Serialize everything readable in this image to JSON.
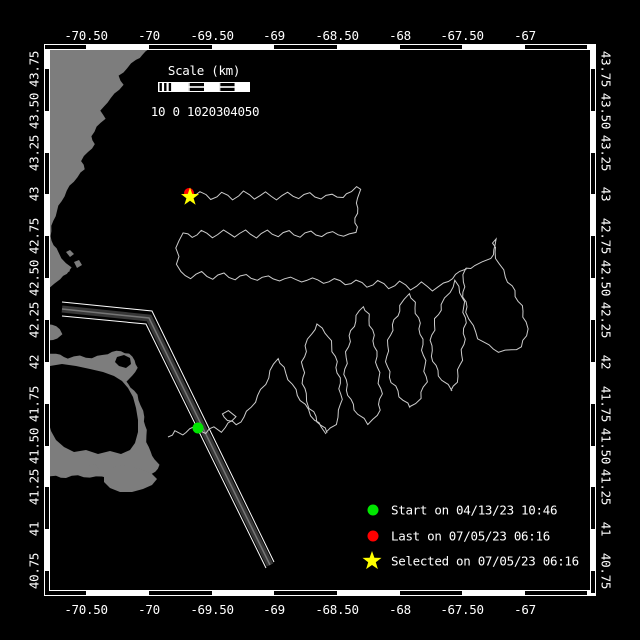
{
  "colors": {
    "background": "#000000",
    "land": "#7d7d7d",
    "water": "#000000",
    "track": "#cccccc",
    "frame_white": "#ffffff",
    "frame_black": "#000000",
    "text": "#ffffff",
    "start_green": "#00e600",
    "last_red": "#ff0000",
    "selected_yellow": "#ffff00",
    "lane_band": "#383838",
    "lane_core": "#757575"
  },
  "axes": {
    "top": {
      "labels": [
        "-70.50",
        "-70",
        "-69.50",
        "-69",
        "-68.50",
        "-68",
        "-67.50",
        "-67"
      ],
      "xs": [
        86,
        149,
        212,
        274,
        337,
        400,
        462,
        525
      ],
      "y": 40
    },
    "bottom": {
      "labels": [
        "-70.50",
        "-70",
        "-69.50",
        "-69",
        "-68.50",
        "-68",
        "-67.50",
        "-67"
      ],
      "xs": [
        86,
        149,
        212,
        274,
        337,
        400,
        462,
        525
      ],
      "y": 614
    },
    "left": {
      "labels": [
        "43.75",
        "43.50",
        "43.25",
        "43",
        "42.75",
        "42.50",
        "42.25",
        "42",
        "41.75",
        "41.50",
        "41.25",
        "41",
        "40.75"
      ],
      "ys": [
        69,
        111,
        153,
        194,
        236,
        278,
        320,
        362,
        404,
        446,
        487,
        529,
        571
      ],
      "x": 34
    },
    "right": {
      "labels": [
        "43.75",
        "43.50",
        "43.25",
        "43",
        "42.75",
        "42.50",
        "42.25",
        "42",
        "41.75",
        "41.50",
        "41.25",
        "41",
        "40.75"
      ],
      "ys": [
        69,
        111,
        153,
        194,
        236,
        278,
        320,
        362,
        404,
        446,
        487,
        529,
        571
      ],
      "x": 606
    }
  },
  "frame": {
    "x0": 44,
    "y0": 44,
    "x1": 596,
    "y1": 596,
    "band": 6,
    "black_lon": [
      [
        45,
        86
      ],
      [
        149,
        212
      ],
      [
        274,
        337
      ],
      [
        400,
        462
      ],
      [
        525,
        587
      ]
    ],
    "black_lat": [
      [
        69,
        111
      ],
      [
        153,
        194
      ],
      [
        236,
        278
      ],
      [
        320,
        362
      ],
      [
        404,
        446
      ],
      [
        487,
        529
      ],
      [
        571,
        593
      ]
    ]
  },
  "scalebar": {
    "title": "Scale (km)",
    "tick_labels": "10 0 1020304050",
    "x": 158,
    "y": 82,
    "w": 92,
    "h": 10,
    "title_cx": 204,
    "title_y": 75,
    "labels_cx": 205,
    "labels_y": 116
  },
  "legend": {
    "sym_x": 373,
    "text_x": 391,
    "ys": [
      510,
      536,
      561
    ],
    "items": [
      {
        "symbol": "dot",
        "color": "#00e600",
        "label": "Start on 04/13/23 10:46"
      },
      {
        "symbol": "dot",
        "color": "#ff0000",
        "label": "Last on 07/05/23 06:16"
      },
      {
        "symbol": "star",
        "color": "#ffff00",
        "label": "Selected on 07/05/23 06:16"
      }
    ]
  },
  "markers": {
    "last": {
      "x": 189,
      "y": 193,
      "r": 5,
      "color": "#ff0000"
    },
    "selected": {
      "x": 190,
      "y": 197,
      "r": 9.5,
      "color": "#ffff00"
    },
    "start": {
      "x": 198,
      "y": 428,
      "r": 5.5,
      "color": "#00e600"
    }
  },
  "land": {
    "mainland": [
      [
        45,
        45
      ],
      [
        152,
        45
      ],
      [
        146,
        52
      ],
      [
        136,
        60
      ],
      [
        127,
        68
      ],
      [
        119,
        76
      ],
      [
        123,
        85
      ],
      [
        115,
        94
      ],
      [
        107,
        102
      ],
      [
        101,
        111
      ],
      [
        105,
        119
      ],
      [
        97,
        127
      ],
      [
        91,
        136
      ],
      [
        95,
        144
      ],
      [
        88,
        152
      ],
      [
        81,
        161
      ],
      [
        85,
        169
      ],
      [
        77,
        177
      ],
      [
        70,
        186
      ],
      [
        64,
        196
      ],
      [
        59,
        206
      ],
      [
        55,
        216
      ],
      [
        52,
        226
      ],
      [
        50,
        236
      ],
      [
        54,
        245
      ],
      [
        58,
        252
      ],
      [
        62,
        258
      ],
      [
        66,
        263
      ],
      [
        71,
        268
      ],
      [
        67,
        274
      ],
      [
        60,
        279
      ],
      [
        54,
        283
      ],
      [
        50,
        288
      ],
      [
        48,
        296
      ],
      [
        50,
        306
      ],
      [
        48,
        316
      ],
      [
        45,
        322
      ],
      [
        52,
        325
      ],
      [
        60,
        329
      ],
      [
        63,
        334
      ],
      [
        57,
        338
      ],
      [
        49,
        341
      ],
      [
        45,
        344
      ]
    ],
    "boston_islets": [
      [
        [
          66,
          252
        ],
        [
          70,
          250
        ],
        [
          74,
          254
        ],
        [
          70,
          257
        ]
      ],
      [
        [
          74,
          262
        ],
        [
          79,
          260
        ],
        [
          82,
          265
        ],
        [
          77,
          268
        ]
      ],
      [
        [
          62,
          268
        ],
        [
          67,
          266
        ],
        [
          70,
          271
        ],
        [
          65,
          274
        ]
      ]
    ],
    "cape": [
      [
        45,
        352
      ],
      [
        56,
        354
      ],
      [
        68,
        358
      ],
      [
        80,
        356
      ],
      [
        92,
        358
      ],
      [
        103,
        355
      ],
      [
        112,
        352
      ],
      [
        121,
        351
      ],
      [
        129,
        354
      ],
      [
        135,
        360
      ],
      [
        137,
        368
      ],
      [
        133,
        376
      ],
      [
        126,
        381
      ],
      [
        131,
        387
      ],
      [
        137,
        395
      ],
      [
        141,
        405
      ],
      [
        144,
        417
      ],
      [
        146,
        430
      ],
      [
        147,
        442
      ],
      [
        150,
        452
      ],
      [
        155,
        459
      ],
      [
        159,
        465
      ],
      [
        156,
        472
      ],
      [
        148,
        476
      ],
      [
        138,
        479
      ],
      [
        126,
        477
      ],
      [
        114,
        479
      ],
      [
        102,
        476
      ],
      [
        90,
        478
      ],
      [
        78,
        475
      ],
      [
        66,
        478
      ],
      [
        56,
        476
      ],
      [
        45,
        478
      ]
    ],
    "bay_cutout": [
      [
        50,
        366
      ],
      [
        62,
        364
      ],
      [
        76,
        366
      ],
      [
        90,
        369
      ],
      [
        103,
        372
      ],
      [
        114,
        376
      ],
      [
        122,
        381
      ],
      [
        128,
        388
      ],
      [
        133,
        397
      ],
      [
        136,
        408
      ],
      [
        138,
        420
      ],
      [
        138,
        432
      ],
      [
        135,
        443
      ],
      [
        130,
        450
      ],
      [
        121,
        454
      ],
      [
        110,
        451
      ],
      [
        98,
        454
      ],
      [
        86,
        450
      ],
      [
        74,
        452
      ],
      [
        64,
        447
      ],
      [
        56,
        440
      ],
      [
        51,
        431
      ],
      [
        48,
        420
      ],
      [
        47,
        407
      ],
      [
        47,
        394
      ],
      [
        48,
        380
      ]
    ],
    "hook_cutout": [
      [
        117,
        357
      ],
      [
        124,
        355
      ],
      [
        130,
        358
      ],
      [
        131,
        364
      ],
      [
        126,
        368
      ],
      [
        119,
        366
      ],
      [
        115,
        362
      ]
    ],
    "islands": [
      [
        [
          104,
          474
        ],
        [
          112,
          468
        ],
        [
          122,
          465
        ],
        [
          133,
          467
        ],
        [
          143,
          470
        ],
        [
          152,
          474
        ],
        [
          157,
          479
        ],
        [
          152,
          485
        ],
        [
          143,
          489
        ],
        [
          132,
          492
        ],
        [
          120,
          492
        ],
        [
          110,
          488
        ],
        [
          104,
          482
        ]
      ],
      [
        [
          88,
          466
        ],
        [
          95,
          464
        ],
        [
          99,
          469
        ],
        [
          94,
          473
        ],
        [
          88,
          471
        ]
      ]
    ]
  },
  "lane": {
    "outer": [
      [
        62,
        302
      ],
      [
        152,
        311
      ],
      [
        274,
        562
      ]
    ],
    "inner": [
      [
        62,
        316
      ],
      [
        146,
        324
      ],
      [
        266,
        568
      ]
    ],
    "band": [
      [
        62,
        309
      ],
      [
        149,
        318
      ],
      [
        270,
        565
      ]
    ]
  },
  "track": {
    "north_rows": [
      [
        190,
        196
      ],
      [
        200,
        192
      ],
      [
        211,
        199
      ],
      [
        222,
        193
      ],
      [
        233,
        199
      ],
      [
        244,
        192
      ],
      [
        255,
        198
      ],
      [
        266,
        193
      ],
      [
        277,
        199
      ],
      [
        288,
        193
      ],
      [
        299,
        198
      ],
      [
        310,
        193
      ],
      [
        321,
        199
      ],
      [
        332,
        194
      ],
      [
        343,
        198
      ],
      [
        351,
        191
      ],
      [
        356,
        186
      ],
      [
        360,
        190
      ],
      [
        357,
        198
      ],
      [
        358,
        208
      ],
      [
        355,
        218
      ],
      [
        357,
        227
      ],
      [
        355,
        232
      ],
      [
        344,
        237
      ],
      [
        333,
        231
      ],
      [
        322,
        237
      ],
      [
        311,
        231
      ],
      [
        300,
        237
      ],
      [
        289,
        231
      ],
      [
        278,
        236
      ],
      [
        267,
        231
      ],
      [
        256,
        237
      ],
      [
        245,
        231
      ],
      [
        234,
        236
      ],
      [
        223,
        231
      ],
      [
        212,
        237
      ],
      [
        201,
        231
      ],
      [
        192,
        237
      ],
      [
        183,
        233
      ],
      [
        178,
        240
      ],
      [
        176,
        248
      ],
      [
        180,
        256
      ],
      [
        176,
        264
      ],
      [
        180,
        272
      ],
      [
        191,
        278
      ],
      [
        202,
        272
      ],
      [
        213,
        279
      ],
      [
        224,
        273
      ],
      [
        235,
        280
      ],
      [
        246,
        274
      ],
      [
        257,
        281
      ],
      [
        268,
        275
      ],
      [
        279,
        282
      ],
      [
        290,
        276
      ],
      [
        301,
        283
      ],
      [
        312,
        277
      ],
      [
        323,
        284
      ],
      [
        334,
        278
      ],
      [
        345,
        285
      ],
      [
        356,
        280
      ],
      [
        367,
        287
      ],
      [
        378,
        281
      ],
      [
        389,
        288
      ],
      [
        400,
        282
      ],
      [
        411,
        289
      ],
      [
        422,
        283
      ],
      [
        433,
        290
      ],
      [
        444,
        284
      ],
      [
        452,
        278
      ],
      [
        460,
        272
      ],
      [
        466,
        268
      ]
    ],
    "approach": [
      [
        168,
        437
      ],
      [
        175,
        431
      ],
      [
        182,
        436
      ],
      [
        189,
        428
      ],
      [
        198,
        428
      ],
      [
        206,
        433
      ],
      [
        214,
        427
      ],
      [
        222,
        431
      ],
      [
        229,
        424
      ],
      [
        235,
        416
      ],
      [
        229,
        410
      ],
      [
        222,
        413
      ],
      [
        228,
        420
      ],
      [
        236,
        425
      ],
      [
        244,
        417
      ],
      [
        251,
        407
      ],
      [
        258,
        396
      ],
      [
        265,
        384
      ],
      [
        271,
        371
      ],
      [
        277,
        358
      ],
      [
        283,
        368
      ],
      [
        289,
        379
      ],
      [
        295,
        390
      ],
      [
        301,
        400
      ],
      [
        308,
        410
      ],
      [
        315,
        420
      ],
      [
        321,
        427
      ],
      [
        327,
        433
      ]
    ],
    "loop_b": [
      [
        327,
        433
      ],
      [
        318,
        421
      ],
      [
        310,
        408
      ],
      [
        305,
        394
      ],
      [
        303,
        378
      ],
      [
        303,
        362
      ],
      [
        306,
        346
      ],
      [
        311,
        333
      ],
      [
        318,
        325
      ],
      [
        326,
        332
      ],
      [
        332,
        346
      ],
      [
        336,
        362
      ],
      [
        339,
        378
      ],
      [
        341,
        394
      ],
      [
        340,
        410
      ],
      [
        335,
        424
      ],
      [
        327,
        433
      ]
    ],
    "loop_c": [
      [
        368,
        425
      ],
      [
        358,
        414
      ],
      [
        350,
        400
      ],
      [
        346,
        385
      ],
      [
        345,
        369
      ],
      [
        347,
        352
      ],
      [
        350,
        336
      ],
      [
        355,
        321
      ],
      [
        362,
        306
      ],
      [
        368,
        315
      ],
      [
        372,
        330
      ],
      [
        375,
        346
      ],
      [
        377,
        362
      ],
      [
        379,
        378
      ],
      [
        381,
        394
      ],
      [
        379,
        410
      ],
      [
        374,
        420
      ],
      [
        368,
        425
      ]
    ],
    "loop_d": [
      [
        410,
        408
      ],
      [
        400,
        396
      ],
      [
        392,
        382
      ],
      [
        387,
        367
      ],
      [
        387,
        351
      ],
      [
        390,
        335
      ],
      [
        395,
        320
      ],
      [
        401,
        306
      ],
      [
        408,
        293
      ],
      [
        414,
        303
      ],
      [
        418,
        318
      ],
      [
        421,
        334
      ],
      [
        423,
        350
      ],
      [
        425,
        366
      ],
      [
        426,
        382
      ],
      [
        420,
        398
      ],
      [
        410,
        408
      ]
    ],
    "loop_e": [
      [
        452,
        391
      ],
      [
        442,
        380
      ],
      [
        435,
        366
      ],
      [
        431,
        351
      ],
      [
        432,
        335
      ],
      [
        436,
        319
      ],
      [
        442,
        305
      ],
      [
        449,
        292
      ],
      [
        456,
        281
      ],
      [
        461,
        292
      ],
      [
        464,
        307
      ],
      [
        465,
        323
      ],
      [
        464,
        339
      ],
      [
        462,
        355
      ],
      [
        459,
        370
      ],
      [
        456,
        382
      ],
      [
        452,
        391
      ]
    ],
    "loop_f": [
      [
        466,
        268
      ],
      [
        463,
        282
      ],
      [
        464,
        297
      ],
      [
        467,
        312
      ],
      [
        472,
        326
      ],
      [
        479,
        338
      ],
      [
        488,
        346
      ],
      [
        499,
        351
      ],
      [
        511,
        351
      ],
      [
        521,
        346
      ],
      [
        527,
        336
      ],
      [
        526,
        322
      ],
      [
        521,
        306
      ],
      [
        514,
        291
      ],
      [
        506,
        277
      ],
      [
        499,
        264
      ],
      [
        495,
        252
      ],
      [
        493,
        243
      ],
      [
        497,
        240
      ],
      [
        495,
        250
      ],
      [
        490,
        258
      ],
      [
        483,
        263
      ],
      [
        475,
        266
      ],
      [
        466,
        268
      ]
    ]
  }
}
